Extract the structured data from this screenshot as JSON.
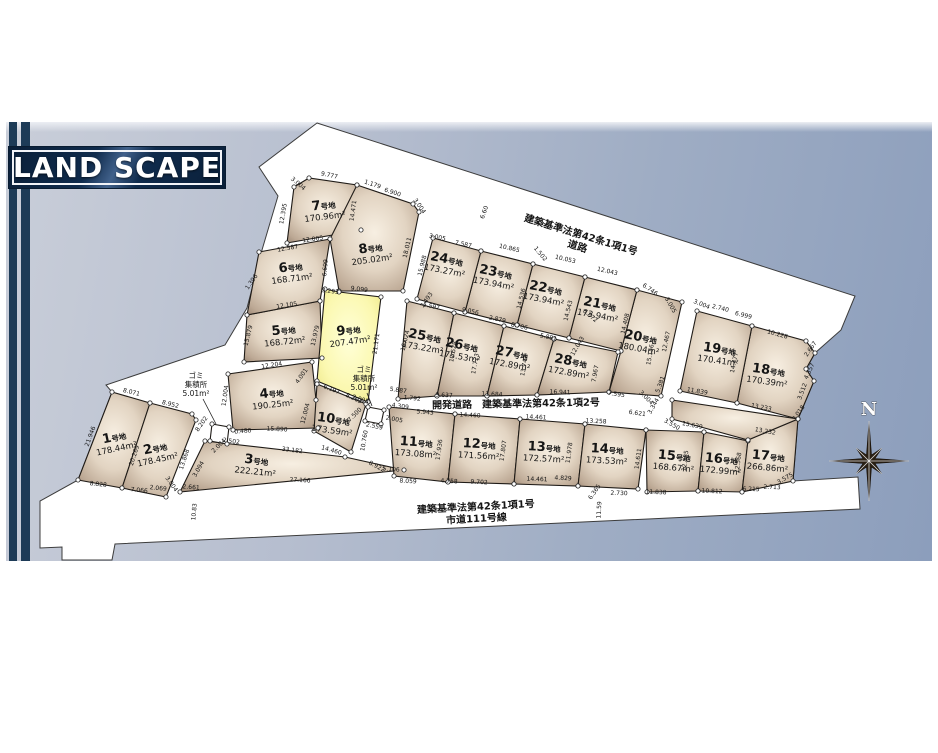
{
  "title": "LAND SCAPE",
  "compass": {
    "label": "N",
    "cx": 869,
    "cy": 461,
    "r_long": 40,
    "r_short": 18,
    "r_inner": 6.5
  },
  "colors": {
    "banner_bg": "#0e2440",
    "stripe": "#1d3b57",
    "road": "#ffffff",
    "plot_edge": "#8d7968",
    "plot_face": "#f7efe2",
    "highlight": "#fbf8b0",
    "bg_top_right": "#8c9ebc",
    "bg_bottom_left": "#c9ced9",
    "line": "#1f1b17"
  },
  "map": {
    "site_outline": "317,123 855,296 841,330 815,353 806,369 814,381 798,419 793,481 858,477 860,509 115,544 112,560 62,560 62,547 40,548 40,501 78,480 112,392 106,385 225,345 247,308 262,250 278,196 259,167",
    "plots": [
      {
        "id": "1",
        "num": "1",
        "suffix": "号地",
        "area": "178.44m²",
        "lx": 115,
        "ly": 441,
        "rot": -12,
        "points": "112,392 150,403 122,488 78,480",
        "type": "normal"
      },
      {
        "id": "2",
        "num": "2",
        "suffix": "号地",
        "area": "178.45m²",
        "lx": 156,
        "ly": 452,
        "rot": -12,
        "points": "150,403 192,414 196,420 166,497 122,488",
        "type": "normal"
      },
      {
        "id": "3",
        "num": "3",
        "suffix": "号地",
        "area": "222.21m²",
        "lx": 256,
        "ly": 464,
        "rot": 6,
        "points": "205,441 345,457 404,470 180,492",
        "type": "normal"
      },
      {
        "id": "4",
        "num": "4",
        "suffix": "号地",
        "area": "190.25m²",
        "lx": 272,
        "ly": 397,
        "rot": -6,
        "points": "228,374 312,362 316,400 318,428 233,430",
        "type": "normal"
      },
      {
        "id": "5",
        "num": "5",
        "suffix": "号地",
        "area": "168.72m²",
        "lx": 284,
        "ly": 334,
        "rot": -6,
        "points": "247,315 320,301 322,358 244,362",
        "type": "normal"
      },
      {
        "id": "6",
        "num": "6",
        "suffix": "号地",
        "area": "168.71m²",
        "lx": 291,
        "ly": 271,
        "rot": -7,
        "points": "259,252 330,239 320,301 247,315",
        "type": "normal"
      },
      {
        "id": "7",
        "num": "7",
        "suffix": "号地",
        "area": "170.96m²",
        "lx": 324,
        "ly": 209,
        "rot": -7,
        "points": "294,187 309,178 357,185 361,230 287,243",
        "type": "normal"
      },
      {
        "id": "8",
        "num": "8",
        "suffix": "号地",
        "area": "205.02m²",
        "lx": 371,
        "ly": 252,
        "rot": -8,
        "points": "357,185 413,204 419,212 403,291 339,291 330,239",
        "type": "normal"
      },
      {
        "id": "9",
        "num": "9",
        "suffix": "号地",
        "area": "207.47m²",
        "lx": 349,
        "ly": 334,
        "rot": -8,
        "points": "325,289 339,292 381,297 368,402 317,381",
        "type": "highlight"
      },
      {
        "id": "10",
        "num": "10",
        "suffix": "号地",
        "area": "173.59m²",
        "lx": 333,
        "ly": 423,
        "rot": 8,
        "points": "317,384 366,404 351,452 314,431",
        "type": "normal"
      },
      {
        "id": "11",
        "num": "11",
        "suffix": "号地",
        "area": "173.08m²",
        "lx": 416,
        "ly": 446,
        "rot": 4,
        "points": "389,407 455,414 448,482 394,476",
        "type": "normal"
      },
      {
        "id": "12",
        "num": "12",
        "suffix": "号地",
        "area": "171.56m²",
        "lx": 479,
        "ly": 448,
        "rot": 3,
        "points": "455,414 520,419 514,484 448,482",
        "type": "normal"
      },
      {
        "id": "13",
        "num": "13",
        "suffix": "号地",
        "area": "172.57m²",
        "lx": 544,
        "ly": 451,
        "rot": 3,
        "points": "520,419 585,424 578,486 514,484",
        "type": "normal"
      },
      {
        "id": "14",
        "num": "14",
        "suffix": "号地",
        "area": "173.53m²",
        "lx": 607,
        "ly": 453,
        "rot": 3,
        "points": "585,424 646,430 638,489 578,486",
        "type": "normal"
      },
      {
        "id": "15",
        "num": "15",
        "suffix": "号地",
        "area": "168.67m²",
        "lx": 674,
        "ly": 460,
        "rot": 5,
        "points": "646,430 704,432 698,491 647,492",
        "type": "normal"
      },
      {
        "id": "16",
        "num": "16",
        "suffix": "号地",
        "area": "172.99m²",
        "lx": 721,
        "ly": 463,
        "rot": 5,
        "points": "704,432 748,441 742,492 698,491",
        "type": "normal"
      },
      {
        "id": "17",
        "num": "17",
        "suffix": "号地",
        "area": "266.86m²",
        "lx": 768,
        "ly": 460,
        "rot": 5,
        "points": "748,440 798,419 793,481 742,492",
        "type": "normal"
      },
      {
        "id": "17b",
        "num": "",
        "suffix": "",
        "area": "",
        "lx": 0,
        "ly": 0,
        "rot": 0,
        "points": "672,400 798,419 748,440 672,419",
        "type": "normal"
      },
      {
        "id": "18",
        "num": "18",
        "suffix": "号地",
        "area": "170.39m²",
        "lx": 768,
        "ly": 374,
        "rot": 8,
        "points": "752,326 806,341 815,353 806,369 814,381 798,419 737,403",
        "type": "normal"
      },
      {
        "id": "19",
        "num": "19",
        "suffix": "号地",
        "area": "170.41m²",
        "lx": 719,
        "ly": 353,
        "rot": 8,
        "points": "697,311 752,326 737,403 680,391",
        "type": "normal"
      },
      {
        "id": "20",
        "num": "20",
        "suffix": "号地",
        "area": "180.04m²",
        "lx": 640,
        "ly": 341,
        "rot": 10,
        "points": "637,290 682,302 661,396 609,392 621,351",
        "type": "normal"
      },
      {
        "id": "21",
        "num": "21",
        "suffix": "号地",
        "area": "173.94m²",
        "lx": 599,
        "ly": 308,
        "rot": 11,
        "points": "585,277 637,290 621,351 569,338",
        "type": "normal"
      },
      {
        "id": "22",
        "num": "22",
        "suffix": "号地",
        "area": "173.94m²",
        "lx": 545,
        "ly": 292,
        "rot": 11,
        "points": "533,264 585,277 569,338 517,325",
        "type": "normal"
      },
      {
        "id": "23",
        "num": "23",
        "suffix": "号地",
        "area": "173.94m²",
        "lx": 495,
        "ly": 276,
        "rot": 11,
        "points": "481,251 533,264 517,325 465,312",
        "type": "normal"
      },
      {
        "id": "24",
        "num": "24",
        "suffix": "号地",
        "area": "173.27m²",
        "lx": 446,
        "ly": 263,
        "rot": 11,
        "points": "433,238 481,251 465,312 417,299",
        "type": "normal"
      },
      {
        "id": "25",
        "num": "25",
        "suffix": "号地",
        "area": "173.22m²",
        "lx": 424,
        "ly": 340,
        "rot": 10,
        "points": "407,301 454,313 437,396 398,399",
        "type": "normal"
      },
      {
        "id": "26",
        "num": "26",
        "suffix": "号地",
        "area": "175.53m²",
        "lx": 461,
        "ly": 349,
        "rot": 10,
        "points": "454,313 504,326 487,396 437,396",
        "type": "normal"
      },
      {
        "id": "27",
        "num": "27",
        "suffix": "号地",
        "area": "172.89m²",
        "lx": 511,
        "ly": 357,
        "rot": 10,
        "points": "504,326 554,339 537,395 487,396",
        "type": "normal"
      },
      {
        "id": "28",
        "num": "28",
        "suffix": "号地",
        "area": "172.89m²",
        "lx": 570,
        "ly": 365,
        "rot": 10,
        "points": "554,339 618,352 609,392 537,395",
        "type": "normal"
      },
      {
        "id": "gomi-left",
        "num": "",
        "suffix": "",
        "area": "",
        "lx": 0,
        "ly": 0,
        "rot": 0,
        "points": "212,424 229,427 227,444 210,441",
        "type": "white"
      },
      {
        "id": "gomi-mid",
        "num": "",
        "suffix": "",
        "area": "",
        "lx": 0,
        "ly": 0,
        "rot": 0,
        "points": "368,407 384,410 381,424 365,421",
        "type": "white"
      }
    ],
    "gomi_labels": [
      {
        "lines": [
          "ゴミ",
          "集積所",
          "5.01m²"
        ],
        "x": 196,
        "y": 378,
        "leader": [
          203,
          399,
          216,
          424
        ]
      },
      {
        "lines": [
          "ゴミ",
          "集積所",
          "5.01m²"
        ],
        "x": 364,
        "y": 372,
        "leader": [
          367,
          393,
          372,
          406
        ]
      }
    ],
    "road_labels": [
      {
        "lines": [
          "建築基準法第42条1項1号",
          "道路"
        ],
        "x": 580,
        "y": 238,
        "rot": 17
      },
      {
        "lines": [
          "開発道路　建築基準法第42条1項2号"
        ],
        "x": 516,
        "y": 407,
        "rot": -1
      },
      {
        "lines": [
          "建築基準法第42条1項1号",
          "市道111号線"
        ],
        "x": 476,
        "y": 510,
        "rot": -3
      }
    ],
    "dims": [
      [
        "9.777",
        329,
        177,
        12
      ],
      [
        "3.004",
        297,
        185,
        40
      ],
      [
        "1.179",
        372,
        186,
        18
      ],
      [
        "6.900",
        392,
        194,
        18
      ],
      [
        "3.004",
        418,
        207,
        55
      ],
      [
        "12.395",
        285,
        214,
        -80
      ],
      [
        "14.471",
        355,
        211,
        -82
      ],
      [
        "12.005",
        313,
        241,
        -8
      ],
      [
        "18.011",
        409,
        248,
        -77
      ],
      [
        "12.587",
        288,
        250,
        -10
      ],
      [
        "1.396",
        253,
        283,
        -55
      ],
      [
        "6.699",
        327,
        268,
        -85
      ],
      [
        "12.105",
        287,
        307,
        -9
      ],
      [
        "15.879",
        250,
        336,
        -76
      ],
      [
        "9.099",
        359,
        291,
        7
      ],
      [
        "3.293",
        330,
        293,
        7
      ],
      [
        "13.979",
        317,
        336,
        -77
      ],
      [
        "21.171",
        378,
        344,
        -82
      ],
      [
        "12.204",
        272,
        367,
        -9
      ],
      [
        "4.001",
        303,
        377,
        -55
      ],
      [
        "12.004",
        227,
        396,
        -82
      ],
      [
        "6.197",
        331,
        391,
        22
      ],
      [
        "8.263",
        353,
        400,
        25
      ],
      [
        "0.480",
        243,
        433,
        -5
      ],
      [
        "15.890",
        277,
        431,
        3
      ],
      [
        "12.004",
        307,
        414,
        -75
      ],
      [
        "14.460",
        331,
        452,
        16
      ],
      [
        "33.182",
        292,
        452,
        7
      ],
      [
        "2.661",
        191,
        489,
        4
      ],
      [
        "27.166",
        300,
        482,
        3
      ],
      [
        "5.106",
        391,
        471,
        4
      ],
      [
        "10.83",
        196,
        512,
        -85
      ],
      [
        "8.202",
        203,
        425,
        -55
      ],
      [
        "2.502",
        231,
        443,
        8
      ],
      [
        "2.004",
        220,
        447,
        -45
      ],
      [
        "3.094",
        200,
        470,
        -60
      ],
      [
        "13.868",
        186,
        460,
        -72
      ],
      [
        "8.071",
        131,
        394,
        14
      ],
      [
        "8.952",
        170,
        406,
        14
      ],
      [
        "21.946",
        92,
        437,
        -70
      ],
      [
        "20.269",
        136,
        456,
        -72
      ],
      [
        "8.828",
        98,
        486,
        6
      ],
      [
        "7.066",
        139,
        492,
        6
      ],
      [
        "2.069",
        158,
        490,
        6
      ],
      [
        "3.004",
        170,
        485,
        55
      ],
      [
        "2.005",
        360,
        401,
        18
      ],
      [
        "4.309",
        400,
        408,
        8
      ],
      [
        "2.005",
        394,
        421,
        10
      ],
      [
        "2.559",
        374,
        428,
        12
      ],
      [
        "7.500",
        356,
        416,
        -45
      ],
      [
        "10.760",
        366,
        441,
        -80
      ],
      [
        "8.922",
        376,
        468,
        28
      ],
      [
        "5.887",
        398,
        392,
        8
      ],
      [
        "1.792",
        412,
        400,
        6
      ],
      [
        "9.637",
        444,
        397,
        3
      ],
      [
        "11.684",
        492,
        396,
        2
      ],
      [
        "16.941",
        560,
        394,
        2
      ],
      [
        "5.943",
        425,
        414,
        4
      ],
      [
        "14.460",
        470,
        417,
        3
      ],
      [
        "14.461",
        536,
        419,
        3
      ],
      [
        "13.258",
        596,
        423,
        3
      ],
      [
        "8.059",
        408,
        483,
        3
      ],
      [
        "4.758",
        449,
        483,
        3
      ],
      [
        "9.702",
        479,
        484,
        3
      ],
      [
        "14.461",
        537,
        481,
        2
      ],
      [
        "4.829",
        563,
        480,
        3
      ],
      [
        "11.59",
        601,
        510,
        -87
      ],
      [
        "6.365",
        596,
        493,
        -55
      ],
      [
        "2.730",
        619,
        495,
        2
      ],
      [
        "11.838",
        656,
        494,
        2
      ],
      [
        "10.812",
        712,
        493,
        2
      ],
      [
        "6.215",
        751,
        491,
        2
      ],
      [
        "2.713",
        772,
        489,
        2
      ],
      [
        "3.575",
        786,
        480,
        -30
      ],
      [
        "17.936",
        441,
        450,
        -82
      ],
      [
        "17.807",
        505,
        451,
        -82
      ],
      [
        "11.978",
        571,
        453,
        -82
      ],
      [
        "14.611",
        640,
        459,
        -82
      ],
      [
        "12.835",
        687,
        461,
        -82
      ],
      [
        "12.568",
        740,
        463,
        -82
      ],
      [
        "15.988",
        424,
        266,
        -76
      ],
      [
        "5.597",
        431,
        308,
        12
      ],
      [
        "9.056",
        470,
        313,
        12
      ],
      [
        "2.879",
        497,
        321,
        12
      ],
      [
        "8.706",
        519,
        328,
        12
      ],
      [
        "5.881",
        548,
        339,
        12
      ],
      [
        "16.024",
        407,
        341,
        -76
      ],
      [
        "17.528",
        455,
        352,
        -80
      ],
      [
        "17.723",
        477,
        364,
        -80
      ],
      [
        "13.747",
        526,
        366,
        -80
      ],
      [
        "3.493",
        428,
        301,
        -55
      ],
      [
        "3.005",
        437,
        239,
        12
      ],
      [
        "7.587",
        463,
        246,
        12
      ],
      [
        "10.865",
        509,
        250,
        13
      ],
      [
        "1.502",
        539,
        255,
        50
      ],
      [
        "10.053",
        565,
        261,
        13
      ],
      [
        "12.043",
        607,
        273,
        13
      ],
      [
        "14.536",
        523,
        299,
        -76
      ],
      [
        "14.543",
        570,
        311,
        -76
      ],
      [
        "6.60",
        486,
        213,
        -70
      ],
      [
        "6.746",
        649,
        291,
        35
      ],
      [
        "3.005",
        669,
        306,
        60
      ],
      [
        "14.408",
        627,
        324,
        -77
      ],
      [
        "12.467",
        668,
        342,
        -78
      ],
      [
        "15.156",
        652,
        355,
        -80
      ],
      [
        "7.595",
        616,
        396,
        8
      ],
      [
        "3.004",
        645,
        399,
        45
      ],
      [
        "7.967",
        597,
        374,
        -80
      ],
      [
        "12.043",
        579,
        347,
        -60
      ],
      [
        "6.872",
        589,
        317,
        40
      ],
      [
        "5.381",
        662,
        385,
        -70
      ],
      [
        "3.344",
        655,
        407,
        -60
      ],
      [
        "6.621",
        637,
        415,
        8
      ],
      [
        "3.550",
        671,
        426,
        30
      ],
      [
        "3.004",
        701,
        306,
        22
      ],
      [
        "2.740",
        720,
        310,
        14
      ],
      [
        "6.999",
        743,
        317,
        14
      ],
      [
        "10.228",
        777,
        336,
        15
      ],
      [
        "14.477",
        736,
        363,
        -78
      ],
      [
        "11.839",
        697,
        393,
        10
      ],
      [
        "15.639",
        692,
        427,
        11
      ],
      [
        "13.232",
        765,
        433,
        10
      ],
      [
        "13.233",
        761,
        409,
        11
      ],
      [
        "2.667",
        812,
        350,
        -55
      ],
      [
        "4.357",
        811,
        372,
        -65
      ],
      [
        "3.512",
        804,
        392,
        -70
      ],
      [
        "3.018",
        800,
        414,
        -55
      ]
    ]
  }
}
